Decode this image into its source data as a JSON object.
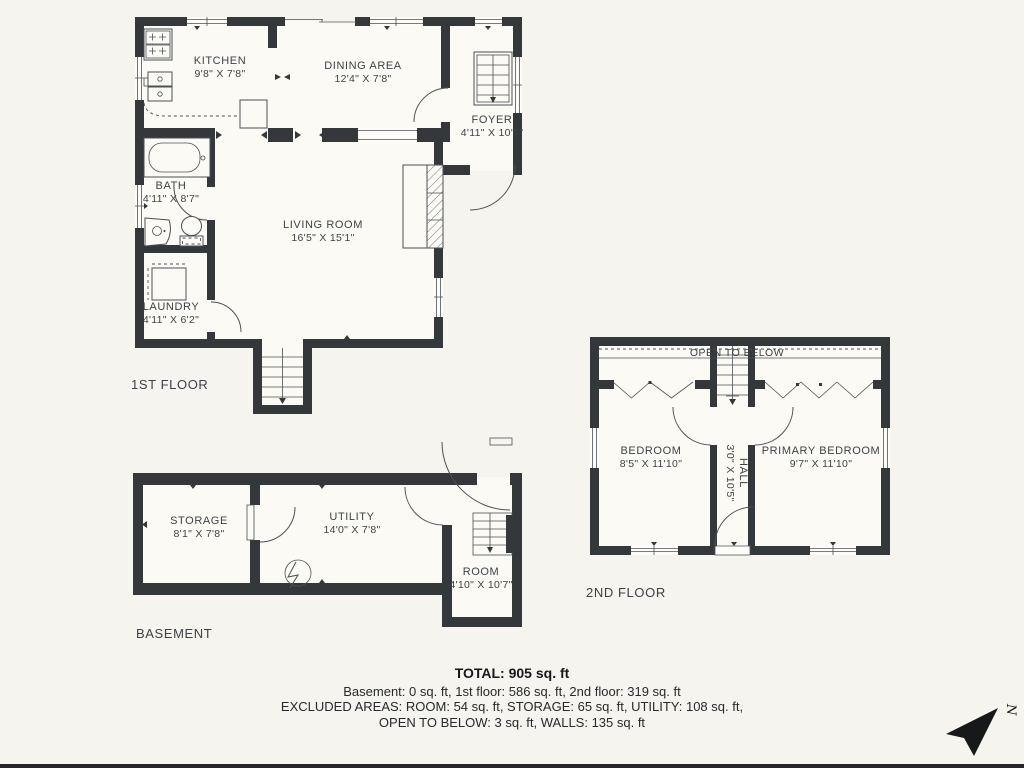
{
  "colors": {
    "bg": "#f5f4ef",
    "wall": "#35383b",
    "line": "#4c5055",
    "text": "#3e4246",
    "interior": "#fbfaf5",
    "winfill": "#fdfcf8"
  },
  "floors": {
    "first": {
      "label": "1ST FLOOR",
      "rooms": {
        "kitchen": {
          "name": "KITCHEN",
          "dims": "9'8\" X 7'8\""
        },
        "dining": {
          "name": "DINING AREA",
          "dims": "12'4\" X 7'8\""
        },
        "foyer": {
          "name": "FOYER",
          "dims": "4'11\" X 10'7\""
        },
        "bath": {
          "name": "BATH",
          "dims": "4'11\" X 8'7\""
        },
        "living": {
          "name": "LIVING ROOM",
          "dims": "16'5\" X 15'1\""
        },
        "laundry": {
          "name": "LAUNDRY",
          "dims": "4'11\" X 6'2\""
        }
      }
    },
    "second": {
      "label": "2ND FLOOR",
      "open_to_below": "OPEN TO BELOW",
      "rooms": {
        "bedroom": {
          "name": "BEDROOM",
          "dims": "8'5\" X 11'10\""
        },
        "hall": {
          "name": "HALL",
          "dims": "3'0\" X 10'5\""
        },
        "primary_bedroom": {
          "name": "PRIMARY BEDROOM",
          "dims": "9'7\" X 11'10\""
        }
      }
    },
    "basement": {
      "label": "BASEMENT",
      "rooms": {
        "storage": {
          "name": "STORAGE",
          "dims": "8'1\" X 7'8\""
        },
        "utility": {
          "name": "UTILITY",
          "dims": "14'0\" X 7'8\""
        },
        "room": {
          "name": "ROOM",
          "dims": "4'10\" X 10'7\""
        }
      }
    }
  },
  "summary": {
    "total": "TOTAL: 905 sq. ft",
    "line2": "Basement: 0 sq. ft, 1st floor: 586 sq. ft, 2nd floor: 319 sq. ft",
    "line3": "EXCLUDED AREAS: ROOM: 54 sq. ft, STORAGE: 65 sq. ft, UTILITY: 108 sq. ft,",
    "line4": "OPEN TO BELOW: 3 sq. ft, WALLS: 135 sq. ft"
  },
  "compass": {
    "label": "N"
  }
}
